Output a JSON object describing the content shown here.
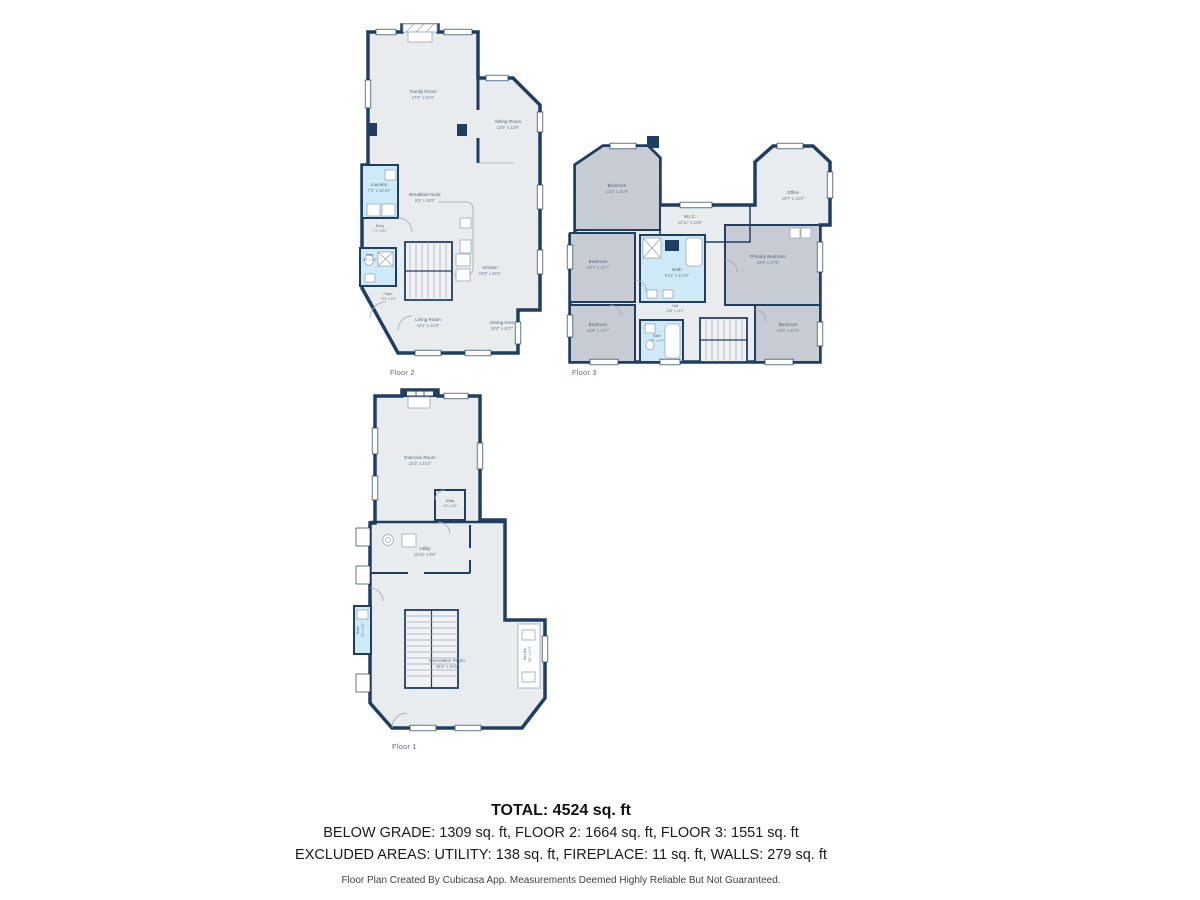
{
  "document": {
    "type": "floor-plan-sheet",
    "creator_note": "Floor Plan Created By Cubicasa App. Measurements Deemed Highly Reliable But Not Guaranteed."
  },
  "colors": {
    "wall": "#1f3e61",
    "room_fill": "#e9ecef",
    "bedroom_fill": "#c7ccd4",
    "wet_room_fill": "#cfeaf7",
    "label_text": "#55687b",
    "summary_text": "#121212"
  },
  "floors": [
    {
      "label": "Floor 2",
      "rooms": [
        {
          "name": "Family Room",
          "dims": "17'9\" x 23'4\""
        },
        {
          "name": "Sitting Room",
          "dims": "13'9\" x 13'9\""
        },
        {
          "name": "Laundry",
          "dims": "7'3\" x 10'10\""
        },
        {
          "name": "Breakfast Nook",
          "dims": "9'5\" x 15'5\""
        },
        {
          "name": "Entry",
          "dims": "7'7\" x 8'1\""
        },
        {
          "name": "Bath",
          "dims": "4'9\" x 5'3\""
        },
        {
          "name": "Foyer",
          "dims": "7'10\" x 9'3\""
        },
        {
          "name": "Kitchen",
          "dims": "15'5\" x 26'1\""
        },
        {
          "name": "Living Room",
          "dims": "13'4\" x 14'3\""
        },
        {
          "name": "Dining Area",
          "dims": "10'0\" x 10'7\""
        }
      ]
    },
    {
      "label": "Floor 3",
      "rooms": [
        {
          "name": "Bedroom",
          "dims": "13'4\" x 15'9\""
        },
        {
          "name": "Office",
          "dims": "13'7\" x 13'2\""
        },
        {
          "name": "W.I.C.",
          "dims": "13'11\" x 13'9\""
        },
        {
          "name": "Bedroom",
          "dims": "10'7\" x 11'7\""
        },
        {
          "name": "Bath",
          "dims": "8'11\" x 11'10\""
        },
        {
          "name": "Primary Bedroom",
          "dims": "22'9\" x 17'8\""
        },
        {
          "name": "Hall",
          "dims": "22'8\" x 15'2\""
        },
        {
          "name": "Bedroom",
          "dims": "13'8\" x 10'7\""
        },
        {
          "name": "Bath",
          "dims": "7'0\" x 7'0\""
        },
        {
          "name": "Bedroom",
          "dims": "12'0\" x 10'3\""
        }
      ]
    },
    {
      "label": "Floor 1",
      "rooms": [
        {
          "name": "Exercise Room",
          "dims": "18'3\" x 24'2\""
        },
        {
          "name": "Utility",
          "dims": "4'4\" x 4'6\""
        },
        {
          "name": "Utility",
          "dims": "16'11\" x 8'6\""
        },
        {
          "name": "Bath",
          "dims": "2'9\" x 6'9\""
        },
        {
          "name": "Recreation Room",
          "dims": "28'5\" x 33'5\""
        },
        {
          "name": "Wet Bar",
          "dims": "8'0\" x 13'3\""
        }
      ]
    }
  ],
  "summary": {
    "total": "TOTAL: 4524 sq. ft",
    "by_floor": "BELOW GRADE: 1309 sq. ft, FLOOR 2: 1664 sq. ft, FLOOR 3: 1551 sq. ft",
    "excluded": "EXCLUDED AREAS: UTILITY: 138 sq. ft, FIREPLACE: 11 sq. ft, WALLS: 279 sq. ft",
    "disclaimer": "Floor Plan Created By Cubicasa App. Measurements Deemed Highly Reliable But Not Guaranteed."
  }
}
